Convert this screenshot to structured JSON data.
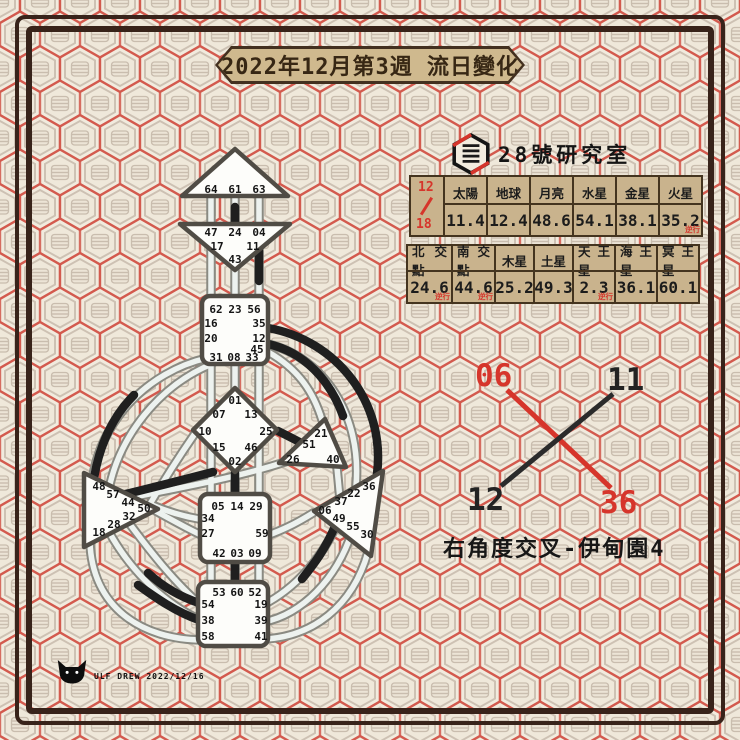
{
  "page": {
    "title_banner": "2022年12月第3週 流日變化"
  },
  "brand": {
    "name": "28號研究室"
  },
  "transit_tables": {
    "date_month": "12",
    "date_day": "18",
    "retro_label": "逆行",
    "row1": {
      "headers": [
        "太陽",
        "地球",
        "月亮",
        "水星",
        "金星",
        "火星"
      ],
      "values": [
        "11.4",
        "12.4",
        "48.6",
        "54.1",
        "38.1",
        "35.2"
      ],
      "retro_flags": [
        false,
        false,
        false,
        false,
        false,
        true
      ]
    },
    "row2": {
      "headers": [
        "北交點",
        "南交點",
        "木星",
        "土星",
        "天王星",
        "海王星",
        "冥王星"
      ],
      "values": [
        "24.6",
        "44.6",
        "25.2",
        "49.3",
        "2.3",
        "36.1",
        "60.1"
      ],
      "retro_flags": [
        true,
        true,
        false,
        false,
        true,
        false,
        false
      ]
    }
  },
  "incarnation_cross": {
    "label": "右角度交叉-伊甸園4",
    "gates": {
      "top_left": "06",
      "top_right": "11",
      "bottom_left": "12",
      "bottom_right": "36"
    },
    "red_line": "06-36",
    "black_line": "11-12"
  },
  "gates": {
    "head": [
      "64",
      "61",
      "63"
    ],
    "ajna": [
      "47",
      "24",
      "04",
      "17",
      "11",
      "43"
    ],
    "throat": [
      "62",
      "23",
      "56",
      "16",
      "35",
      "20",
      "12",
      "45",
      "31",
      "08",
      "33"
    ],
    "g": [
      "01",
      "07",
      "13",
      "10",
      "25",
      "15",
      "46",
      "02"
    ],
    "heart": [
      "21",
      "51",
      "26",
      "40"
    ],
    "solar": [
      "36",
      "22",
      "37",
      "06",
      "49",
      "55",
      "30"
    ],
    "spleen": [
      "48",
      "57",
      "44",
      "50",
      "32",
      "28",
      "18"
    ],
    "sacral": [
      "05",
      "14",
      "29",
      "34",
      "27",
      "59",
      "42",
      "03",
      "09"
    ],
    "root": [
      "53",
      "60",
      "52",
      "54",
      "19",
      "38",
      "39",
      "58",
      "41"
    ]
  },
  "credit": {
    "text": "ULF DREW 2022/12/16"
  },
  "colors": {
    "accent_red": "#d6352b",
    "frame_brown": "#38231a",
    "banner_bg": "#cfb98e",
    "table_bg": "#c9b38d",
    "throat_defined": "#7ec3cf",
    "solar_plexus_defined": "#c29a6a",
    "channel_black": "#1f1f1f"
  }
}
